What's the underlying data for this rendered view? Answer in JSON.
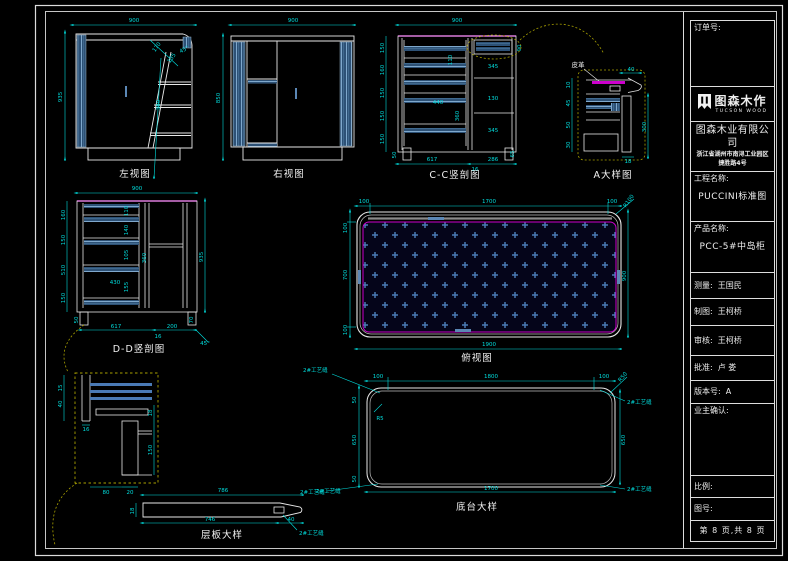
{
  "title_block": {
    "order_label": "订单号:",
    "logo": {
      "name": "图森木作",
      "sub": "TUCSON WOOD"
    },
    "company": "图森木业有限公司",
    "address1": "浙江省湖州市南浔工业园区",
    "address2": "捷胜路4号",
    "project_label": "工程名称:",
    "project_value": "PUCCINI标准图",
    "product_label": "产品名称:",
    "product_value": "PCC-5#中岛柜",
    "measure_label": "测量:",
    "measure_value": "王国民",
    "draft_label": "制图:",
    "draft_value": "王柯桥",
    "audit_label": "审核:",
    "audit_value": "王柯桥",
    "approve_label": "批准:",
    "approve_value": "卢  娄",
    "version_label": "版本号:",
    "version_value": "A",
    "owner_label": "业主确认:",
    "scale_label": "比例:",
    "drawing_no_label": "图号:",
    "page_info": "第 8 页,共 8 页"
  },
  "views": {
    "left": {
      "label": "左视图",
      "w": "900",
      "h": "935",
      "s1": "170",
      "s2": "135",
      "s3": "45°",
      "v": "380"
    },
    "right": {
      "label": "右视图",
      "w": "900",
      "h": "850"
    },
    "cc": {
      "label": "C-C竖剖图",
      "w": "900",
      "left": [
        "150",
        "160",
        "150",
        "150",
        "150"
      ],
      "right": [
        "345",
        "130",
        "345"
      ],
      "inner": [
        "110",
        "440",
        "360"
      ],
      "small": [
        "50",
        "90",
        "50",
        "65"
      ],
      "bottom": [
        "617",
        "16",
        "286"
      ]
    },
    "a": {
      "label": "A大样图",
      "material": "皮革",
      "top": "40",
      "right": "300",
      "bottom": "18",
      "left": [
        "10",
        "45",
        "50",
        "30"
      ]
    },
    "dd": {
      "label": "D-D竖剖图",
      "w": "900",
      "h": "935",
      "left": [
        "160",
        "150",
        "510",
        "150"
      ],
      "inner": [
        "110",
        "140",
        "105",
        "430",
        "155",
        "360"
      ],
      "bottom": [
        "50",
        "617",
        "200",
        "16",
        "70",
        "45°"
      ]
    },
    "plan": {
      "label": "俯视图",
      "top": [
        "100",
        "1700",
        "100"
      ],
      "left": [
        "100",
        "700",
        "100"
      ],
      "right": "900",
      "bottom": "1900",
      "radius": "R100"
    },
    "base": {
      "label": "底台大样",
      "top": [
        "100",
        "1800",
        "100"
      ],
      "left": [
        "50",
        "650",
        "50"
      ],
      "right": "650",
      "bottom": "1700",
      "r_out": "R50",
      "r_in": "R5",
      "seam": "2#工艺缝"
    },
    "shelf": {
      "label": "层板大样",
      "top": "786",
      "bottom": [
        "746",
        "40"
      ],
      "h": "18",
      "seam": "2#工艺缝"
    },
    "corner": {
      "left": [
        "15",
        "40"
      ],
      "mid": "16",
      "right": [
        "18",
        "150"
      ],
      "bottom": [
        "80",
        "20"
      ]
    }
  },
  "colors": {
    "dim": "#00dede",
    "line": "#e8e8e8",
    "panel": "#2d5176",
    "stripe": "#7fa8cc",
    "magenta": "#cc00cc",
    "leader": "#a8a000"
  }
}
